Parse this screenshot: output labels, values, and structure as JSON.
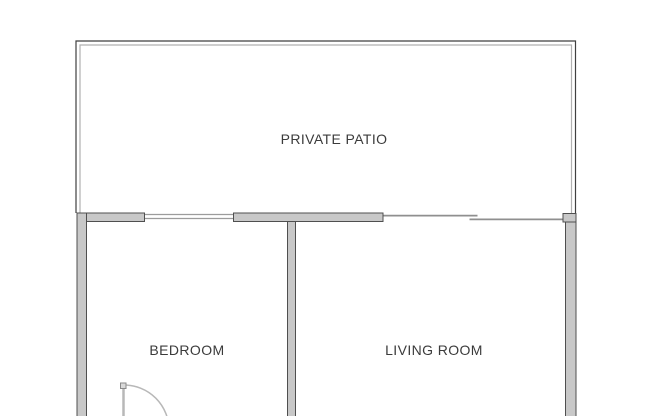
{
  "plan": {
    "labels": {
      "patio": "PRIVATE PATIO",
      "bedroom": "BEDROOM",
      "living_room": "LIVING ROOM"
    },
    "colors": {
      "background": "#ffffff",
      "wall_fill": "#c8c8c8",
      "wall_stroke": "#4f4f4f",
      "thin_wall_dark": "#3f3f3f",
      "thin_wall_light": "#b0b0b0",
      "window_line": "#9c9c9c",
      "slider_line": "#8f8f8f",
      "door_line": "#b8b8b8",
      "door_hinge_fill": "#d9d9d9",
      "door_hinge_stroke": "#8a8a8a",
      "label_text": "#3b3b3b"
    }
  }
}
